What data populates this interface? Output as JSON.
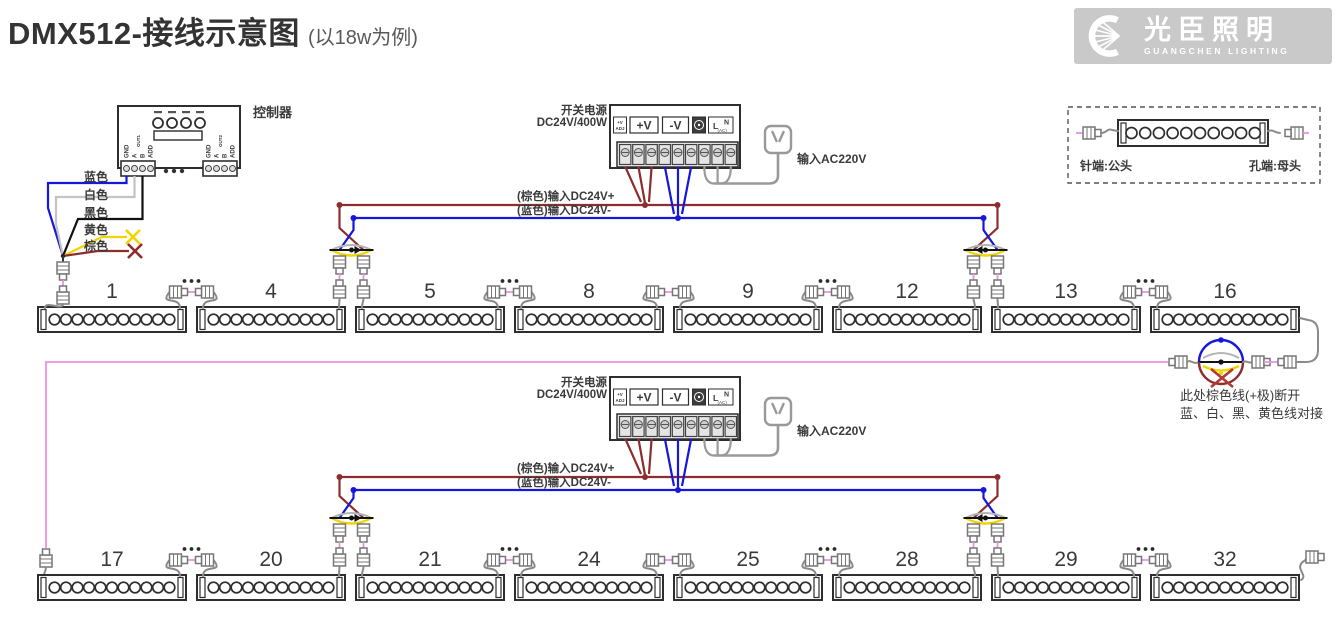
{
  "title": "DMX512-接线示意图",
  "subtitle": "(以18w为例)",
  "logo": {
    "cn": "光臣照明",
    "en": "GUANGCHEN LIGHTING"
  },
  "controller": {
    "label": "控制器",
    "ports": [
      "GND",
      "A",
      "B",
      "ADD"
    ],
    "out1": "OUT1",
    "out2": "OUT2",
    "wires": [
      {
        "label": "蓝色"
      },
      {
        "label": "白色"
      },
      {
        "label": "黑色"
      },
      {
        "label": "黄色"
      },
      {
        "label": "棕色"
      }
    ]
  },
  "psu": {
    "name1": "开关电源",
    "name2": "DC24V/400W",
    "adj1": "+V",
    "adj2": "ADJ",
    "vplus": "+V",
    "vminus": "-V",
    "l": "L",
    "n": "N",
    "ac": "(AC)",
    "ac_input": "输入AC220V",
    "dc_plus": "(棕色)输入DC24V+",
    "dc_minus": "(蓝色)输入DC24V-"
  },
  "legend": {
    "male": "针端:公头",
    "female": "孔端:母头"
  },
  "note": {
    "line1": "此处棕色线(+极)断开",
    "line2": "蓝、白、黑、黄色线对接"
  },
  "rows": [
    [
      "1",
      "4",
      "5",
      "8",
      "9",
      "12",
      "13",
      "16"
    ],
    [
      "17",
      "20",
      "21",
      "24",
      "25",
      "28",
      "29",
      "32"
    ]
  ],
  "colors": {
    "brown": "#8C2E2F",
    "blue": "#1616DE",
    "pink": "#EE8FE8",
    "yellow": "#F2D500",
    "white_wire": "#C3C3C3",
    "black_wire": "#111111",
    "gray_wire": "#9A9A9A",
    "cable": "#8A8A8A",
    "outline": "#2E2E2E",
    "red_x": "#B03A36",
    "text": "#3A3A3A"
  }
}
